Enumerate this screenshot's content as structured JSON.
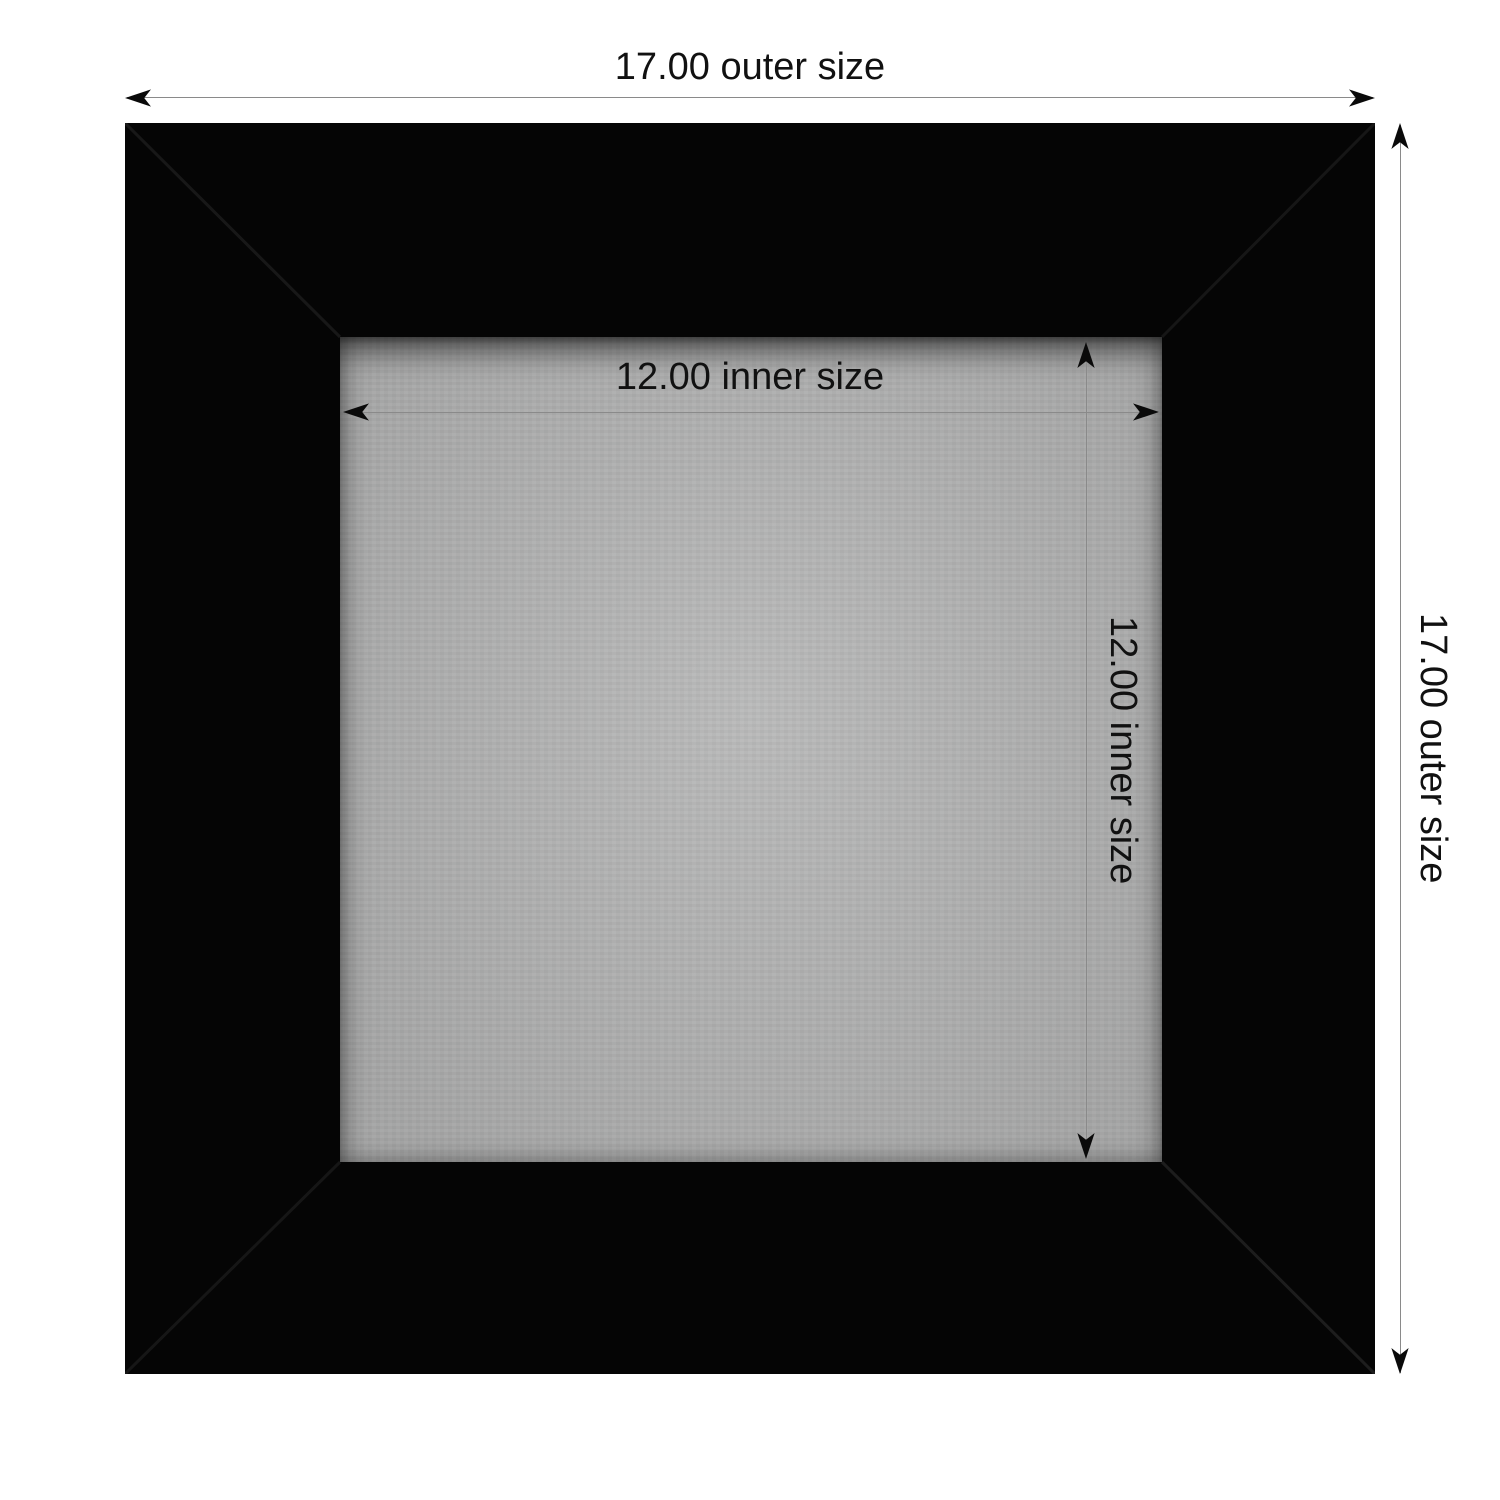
{
  "labels": {
    "outer_width": "17.00 outer size",
    "outer_height": "17.00 outer size",
    "inner_width": "12.00 inner size",
    "inner_height": "12.00 inner size"
  },
  "values": {
    "outer_size": "17.00",
    "inner_size": "12.00"
  },
  "colors": {
    "background": "#ffffff",
    "frame": "#050505",
    "mat": "#b2b3b3",
    "dimension_line": "#8a8a8a",
    "arrow": "#0a0a0a",
    "label_text": "#111111"
  }
}
